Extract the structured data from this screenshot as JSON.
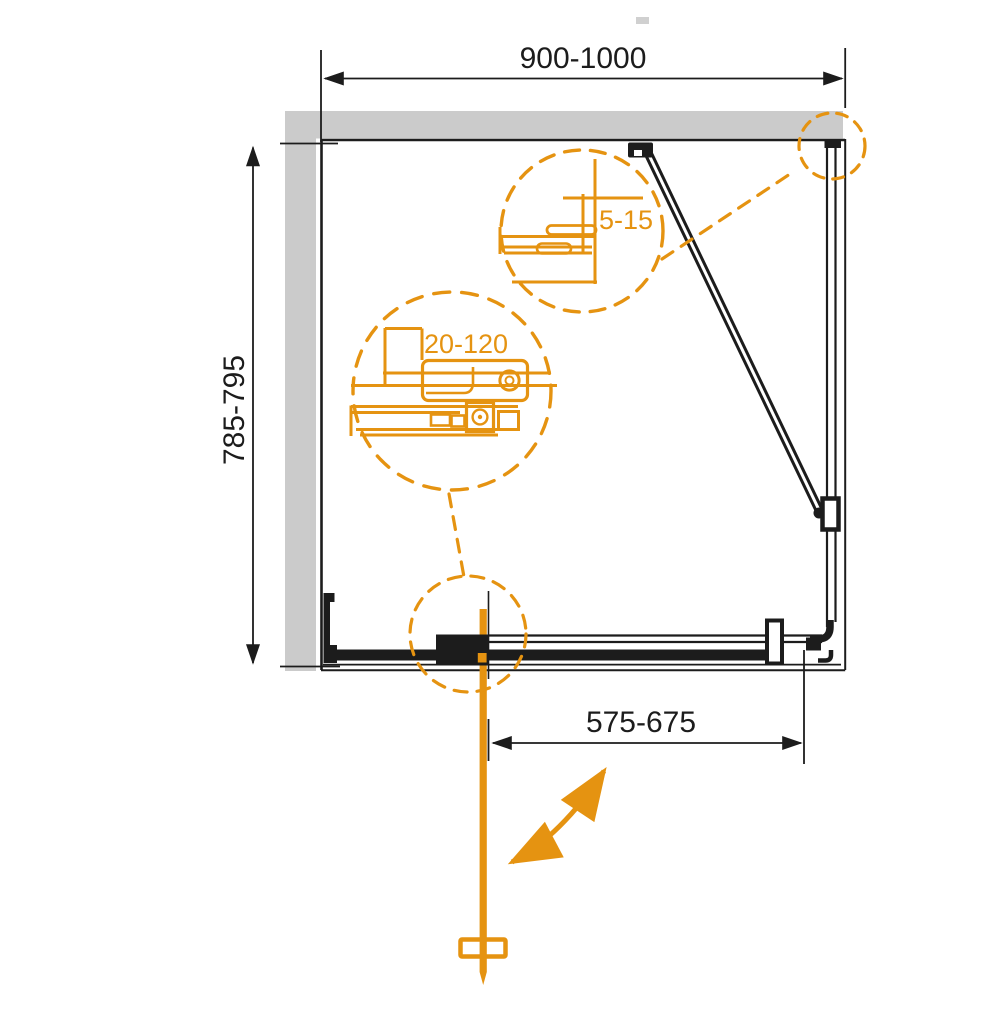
{
  "colors": {
    "line": "#1c1c1c",
    "accent": "#e59311",
    "wall": "#cbcbcb",
    "bg": "#ffffff"
  },
  "dimensions": {
    "overall_width": "900-1000",
    "overall_depth": "785-795",
    "door_width": "575-675",
    "wall_profile_range": "20-120",
    "glass_panel_range": "5-15"
  }
}
